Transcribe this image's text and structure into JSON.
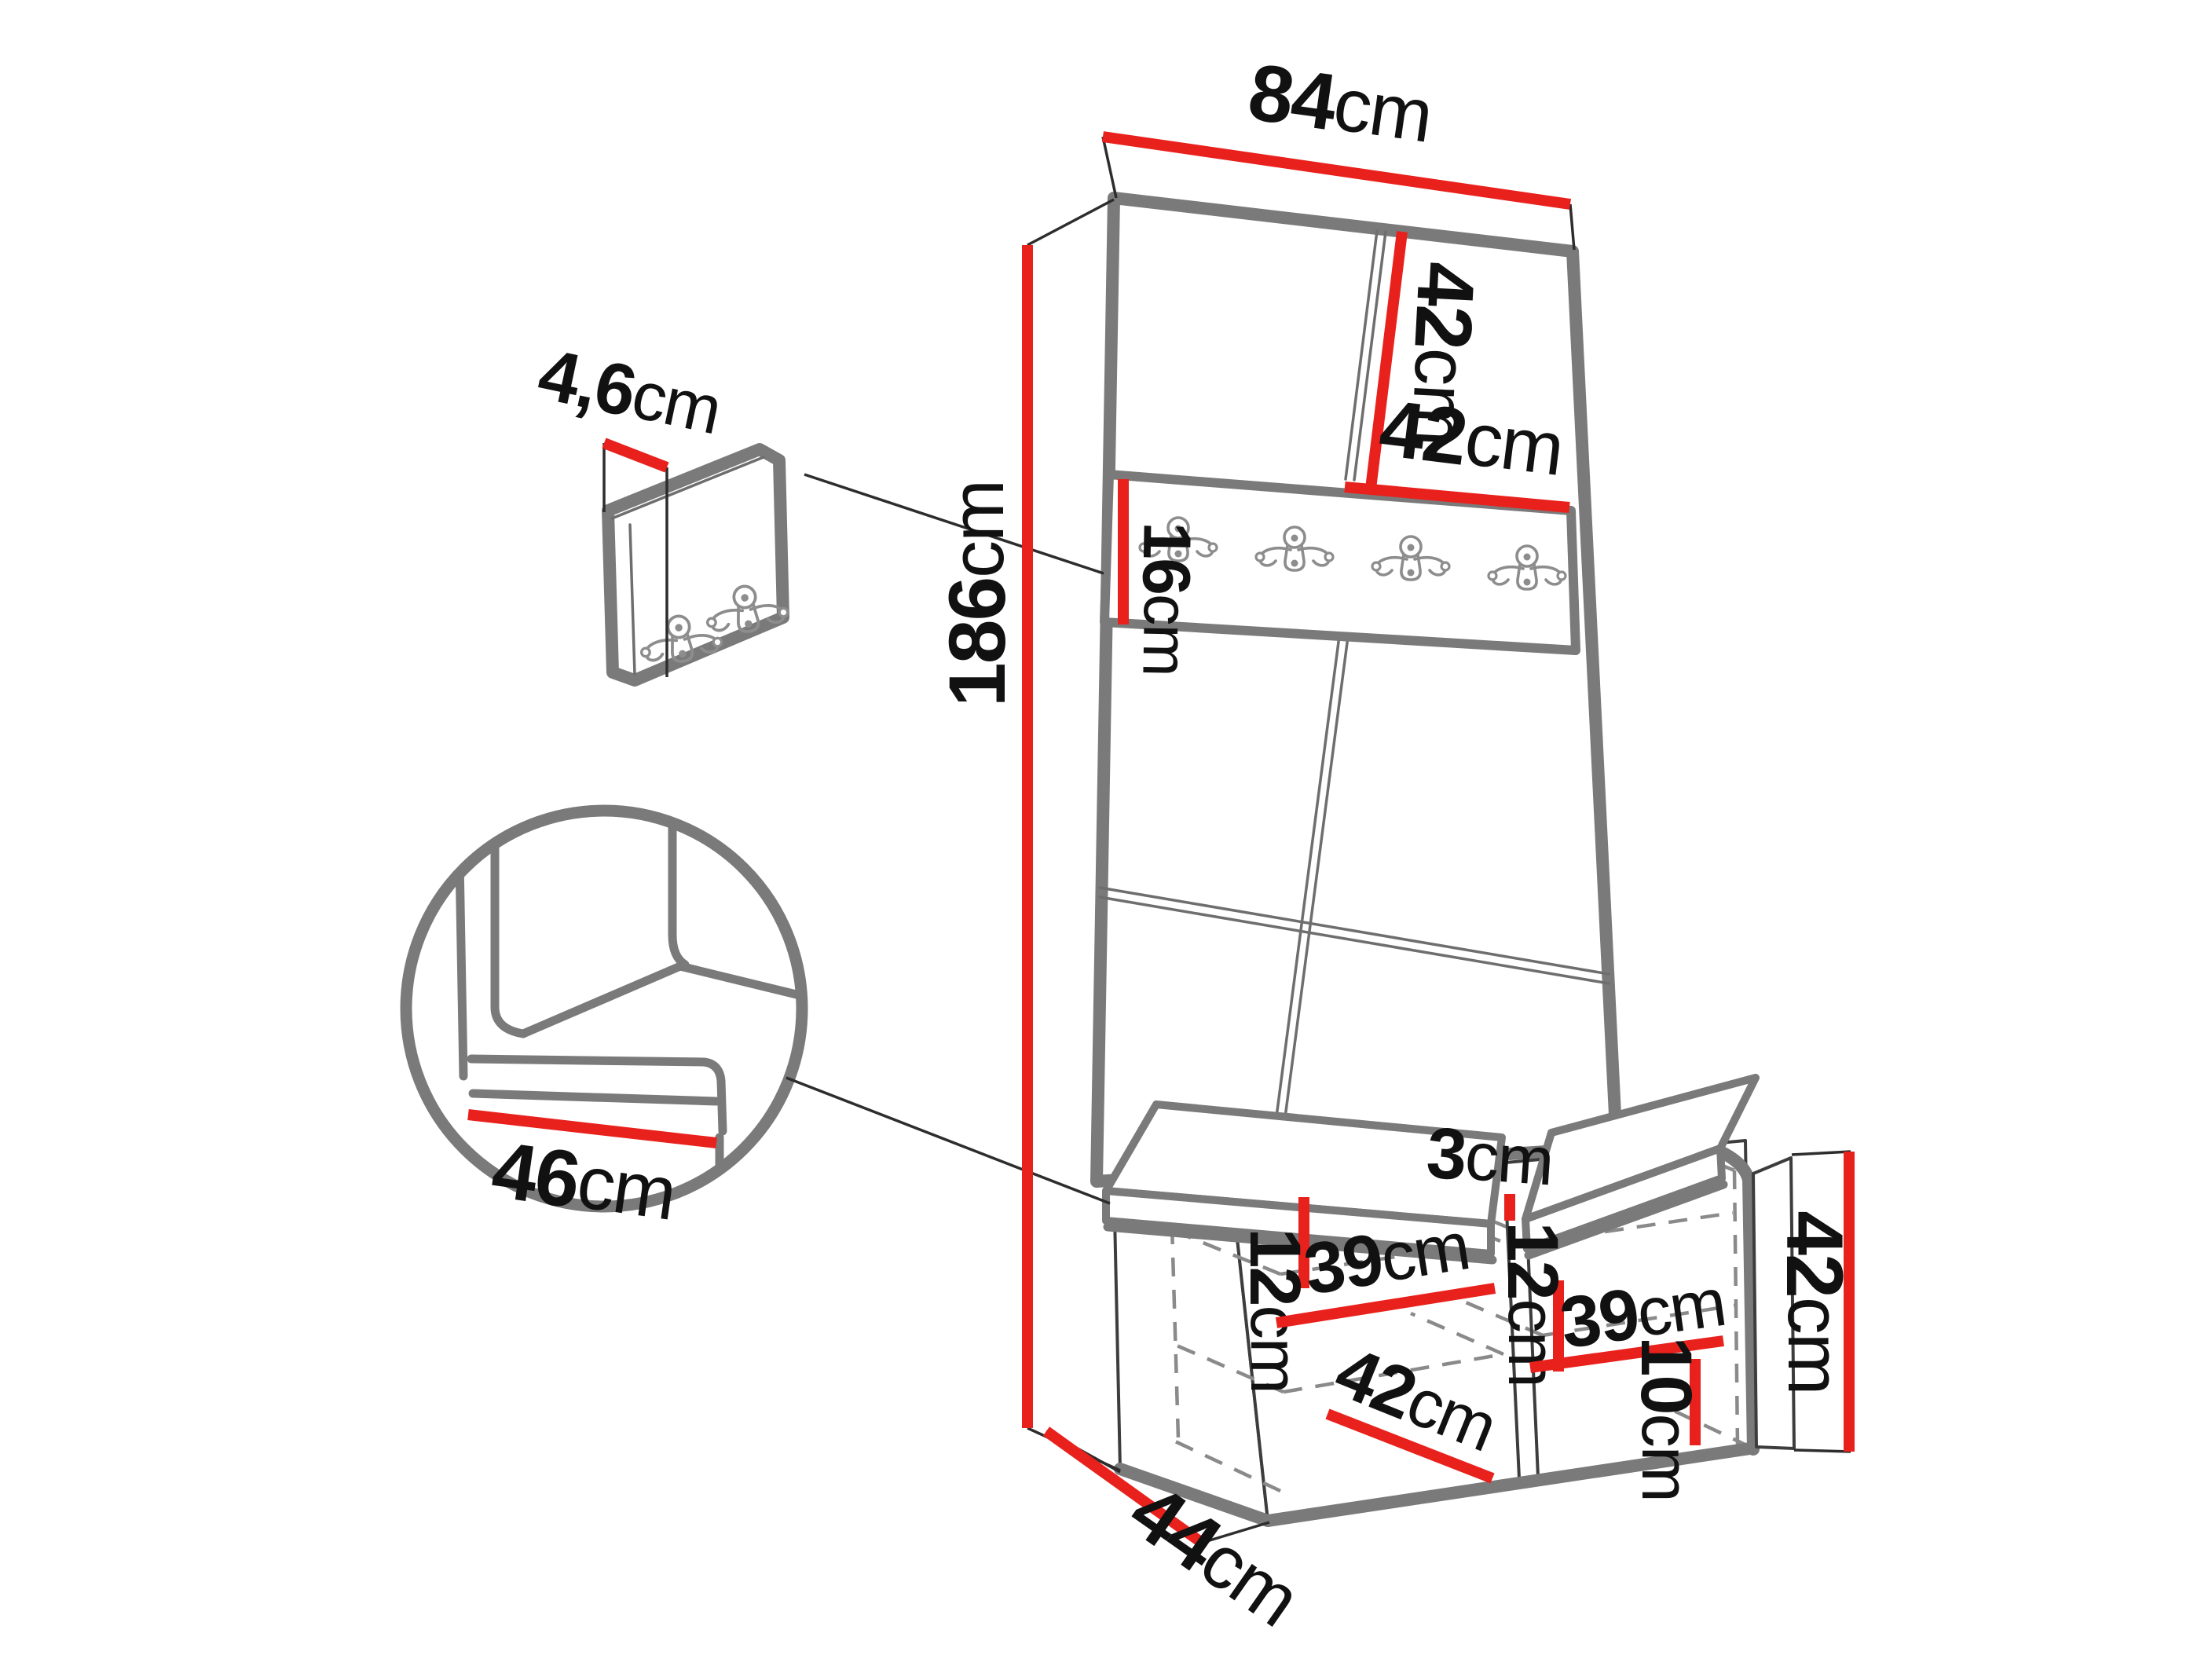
{
  "diagram": {
    "title": "furniture-dimension-diagram",
    "subject": "hallway wardrobe panel with hook rail and shoe bench",
    "unit_system": "cm",
    "colors": {
      "dimension": "#e8211d",
      "outline": "#7a7a7a",
      "thin_line": "#3d3d3d",
      "dashed": "#8a8a8a",
      "text": "#111111",
      "hook": "#8d8d8d"
    },
    "dimensions": {
      "width_top": {
        "value": "84",
        "unit": "cm"
      },
      "top_panel_height": {
        "value": "42",
        "unit": "cm"
      },
      "top_panel_width": {
        "value": "42",
        "unit": "cm"
      },
      "rail_height": {
        "value": "16",
        "unit": "cm"
      },
      "total_height": {
        "value": "186",
        "unit": "cm"
      },
      "hook_board_thickness": {
        "value": "4,6",
        "unit": "cm"
      },
      "seat_depth": {
        "value": "46",
        "unit": "cm"
      },
      "cushion_gap": {
        "value": "3",
        "unit": "cm"
      },
      "shelf_spacing_left": {
        "value": "12",
        "unit": "cm"
      },
      "shelf_width_left": {
        "value": "39",
        "unit": "cm"
      },
      "shelf_spacing_right": {
        "value": "12",
        "unit": "cm"
      },
      "shelf_width_right": {
        "value": "39",
        "unit": "cm"
      },
      "compartment_width": {
        "value": "42",
        "unit": "cm"
      },
      "plinth_height": {
        "value": "10",
        "unit": "cm"
      },
      "bench_height": {
        "value": "42",
        "unit": "cm"
      },
      "bench_depth": {
        "value": "44",
        "unit": "cm"
      }
    }
  }
}
